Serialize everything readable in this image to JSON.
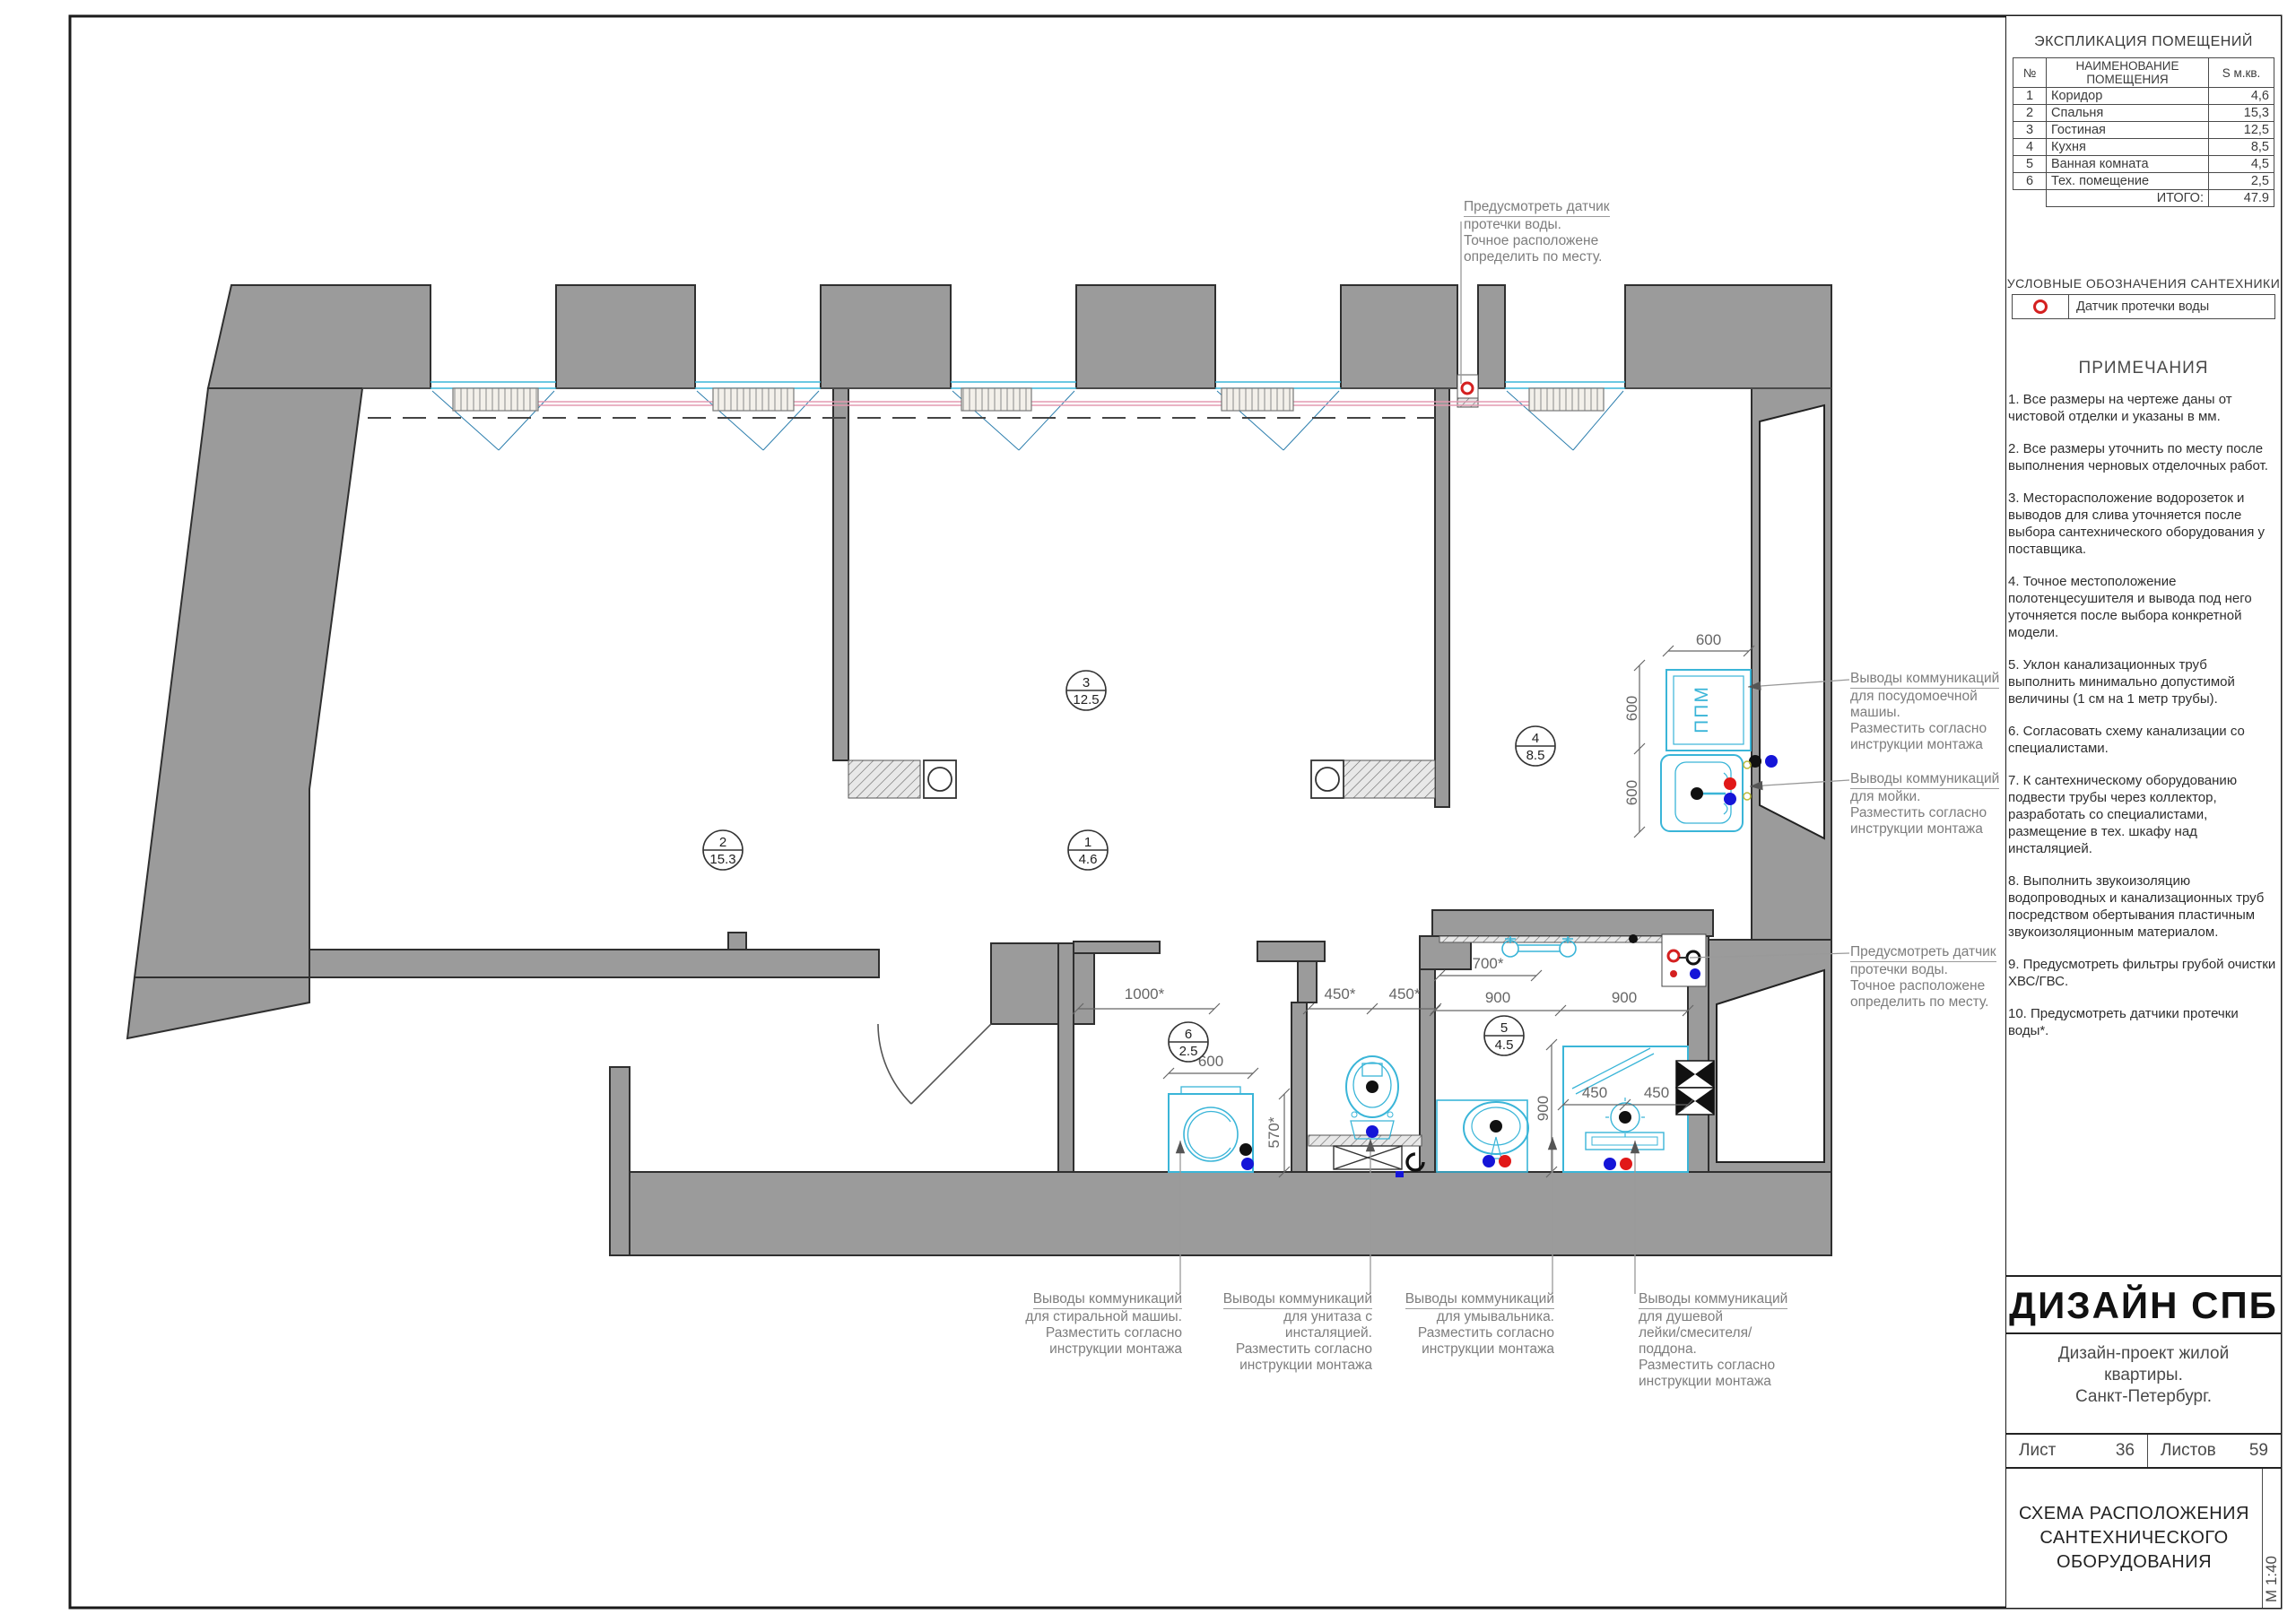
{
  "room_schedule": {
    "title": "ЭКСПЛИКАЦИЯ ПОМЕЩЕНИЙ",
    "col_num": "№",
    "col_name": "НАИМЕНОВАНИЕ ПОМЕЩЕНИЯ",
    "col_area": "S м.кв.",
    "rows": [
      {
        "num": "1",
        "name": "Коридор",
        "area": "4,6"
      },
      {
        "num": "2",
        "name": "Спальня",
        "area": "15,3"
      },
      {
        "num": "3",
        "name": "Гостиная",
        "area": "12,5"
      },
      {
        "num": "4",
        "name": "Кухня",
        "area": "8,5"
      },
      {
        "num": "5",
        "name": "Ванная комната",
        "area": "4,5"
      },
      {
        "num": "6",
        "name": "Тех. помещение",
        "area": "2,5"
      }
    ],
    "total_label": "ИТОГО:",
    "total_value": "47.9"
  },
  "legend": {
    "title": "УСЛОВНЫЕ ОБОЗНАЧЕНИЯ САНТЕХНИКИ",
    "item_label": "Датчик протечки воды"
  },
  "notes": {
    "title": "ПРИМЕЧАНИЯ",
    "items": [
      "1. Все размеры на чертеже даны от чистовой отделки и указаны в мм.",
      "2. Все размеры уточнить по месту после выполнения черновых отделочных работ.",
      "3. Месторасположение водорозеток и выводов для слива уточняется после выбора сантехнического оборудования у поставщика.",
      "4. Точное местоположение полотенцесушителя и вывода под него уточняется после выбора конкретной модели.",
      "5. Уклон канализационных труб выполнить минимально допустимой величины (1 см на 1 метр трубы).",
      "6. Согласовать схему канализации со специалистами.",
      "7. К сантехническому оборудованию подвести трубы через коллектор, разработать со специалистами, размещение в тех. шкафу над инсталяцией.",
      "8. Выполнить звукоизоляцию водопроводных и канализационных труб посредством обертывания пластичным звукоизоляционным материалом.",
      "9. Предусмотреть фильтры грубой очистки ХВС/ГВС.",
      "10. Предусмотреть датчики протечки воды*."
    ]
  },
  "title_block": {
    "company": "ДИЗАЙН СПБ",
    "project_lines": [
      "Дизайн-проект жилой",
      "квартиры.",
      "Санкт-Петербург."
    ],
    "sheet_label": "Лист",
    "sheet_number": "36",
    "sheets_label": "Листов",
    "sheets_total": "59",
    "drawing_title": "СХЕМА РАСПОЛОЖЕНИЯ САНТЕХНИЧЕСКОГО ОБОРУДОВАНИЯ",
    "scale": "М 1:40"
  },
  "annotations": {
    "leak_top": {
      "lines": [
        "Предусмотреть датчик",
        "протечки воды.",
        "Точное расположене",
        "определить по месту."
      ]
    },
    "dishwasher": {
      "lines": [
        "Выводы коммуникаций",
        "для посудомоечной",
        "машиы.",
        "Разместить согласно",
        "инструкции монтажа"
      ]
    },
    "sink_kitchen": {
      "lines": [
        "Выводы коммуникаций",
        "для мойки.",
        "Разместить согласно",
        "инструкции монтажа"
      ]
    },
    "leak_right": {
      "lines": [
        "Предусмотреть датчик",
        "протечки воды.",
        "Точное расположене",
        "определить по месту."
      ]
    },
    "washer": {
      "lines": [
        "Выводы коммуникаций",
        "для стиральной машиы.",
        "Разместить согласно",
        "инструкции монтажа"
      ]
    },
    "toilet": {
      "lines": [
        "Выводы коммуникаций",
        "для унитаза с инсталяцией.",
        "Разместить согласно",
        "инструкции монтажа"
      ]
    },
    "basin": {
      "lines": [
        "Выводы коммуникаций",
        "для умывальника.",
        "Разместить согласно",
        "инструкции монтажа"
      ]
    },
    "shower": {
      "lines": [
        "Выводы коммуникаций",
        "для душевой",
        "лейки/смесителя/поддона.",
        "Разместить согласно",
        "инструкции монтажа"
      ]
    }
  },
  "plan": {
    "labels": {
      "dishwasher": "ППМ"
    },
    "dims": {
      "kitchen_top": "600",
      "kitchen_left_upper": "600",
      "kitchen_left_lower": "600",
      "towel": "700*",
      "tech_width": "1000*",
      "washer_width": "600",
      "washer_depth": "570*",
      "wc_a": "450*",
      "wc_b": "450*",
      "bath_a": "900",
      "bath_b": "900",
      "bath_depth": "900",
      "shower_a": "450",
      "shower_b": "450"
    },
    "rooms": [
      {
        "num": "1",
        "area": "4.6"
      },
      {
        "num": "2",
        "area": "15.3"
      },
      {
        "num": "3",
        "area": "12.5"
      },
      {
        "num": "4",
        "area": "8.5"
      },
      {
        "num": "5",
        "area": "4.5"
      },
      {
        "num": "6",
        "area": "2.5"
      }
    ],
    "colors": {
      "wall": "#9b9b9b",
      "outline": "#2f2f2f",
      "fixture": "#3ab5d8",
      "hot_water": "#e11818",
      "cold_water": "#1515d8",
      "sewage": "#111111",
      "heating_pipe": "#e39ab0",
      "sensor": "#d42020"
    }
  }
}
